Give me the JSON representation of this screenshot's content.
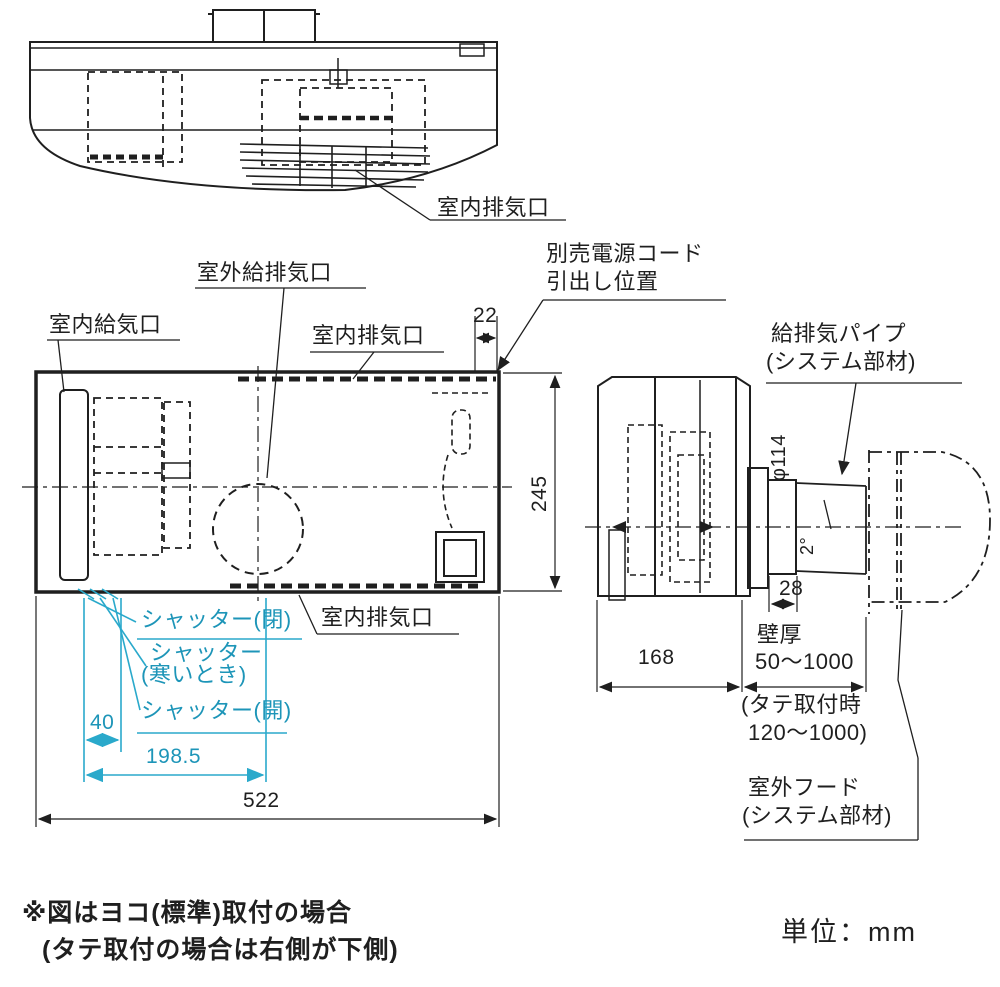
{
  "colors": {
    "line": "#1f1f1f",
    "annotation": "#2aa9cb",
    "annotation_text": "#1d95b8",
    "background": "#ffffff"
  },
  "top_view": {
    "labels": {
      "indoor_exhaust": "室内排気口"
    }
  },
  "front_view": {
    "labels": {
      "outdoor_supply_exhaust": "室外給排気口",
      "indoor_supply": "室内給気口",
      "indoor_exhaust_top": "室内排気口",
      "indoor_exhaust_bottom": "室内排気口",
      "power_cord_line1": "別売電源コード",
      "power_cord_line2": "引出し位置",
      "shutter_closed": "シャッター(閉)",
      "shutter_cold_line1": "シャッター",
      "shutter_cold_line2": "(寒いとき)",
      "shutter_open": "シャッター(開)"
    },
    "dimensions": {
      "cord_offset": "22",
      "height": "245",
      "width": "522",
      "shutter_pivot": "40",
      "shutter_reach": "198.5"
    }
  },
  "side_view": {
    "labels": {
      "pipe_line1": "給排気パイプ",
      "pipe_line2": "(システム部材)",
      "wall_thickness_label": "壁厚",
      "wall_thickness_range": "50～1000",
      "vertical_mount_line1": "(タテ取付時",
      "vertical_mount_line2": "120～1000)",
      "hood_line1": "室外フード",
      "hood_line2": "(システム部材)"
    },
    "dimensions": {
      "depth": "168",
      "pipe_diameter": "φ114",
      "pipe_slope": "2°",
      "pipe_protrusion": "28"
    }
  },
  "footer": {
    "note_line1": "※図はヨコ(標準)取付の場合",
    "note_line2": "(タテ取付の場合は右側が下側)",
    "units": "単位：mm"
  }
}
